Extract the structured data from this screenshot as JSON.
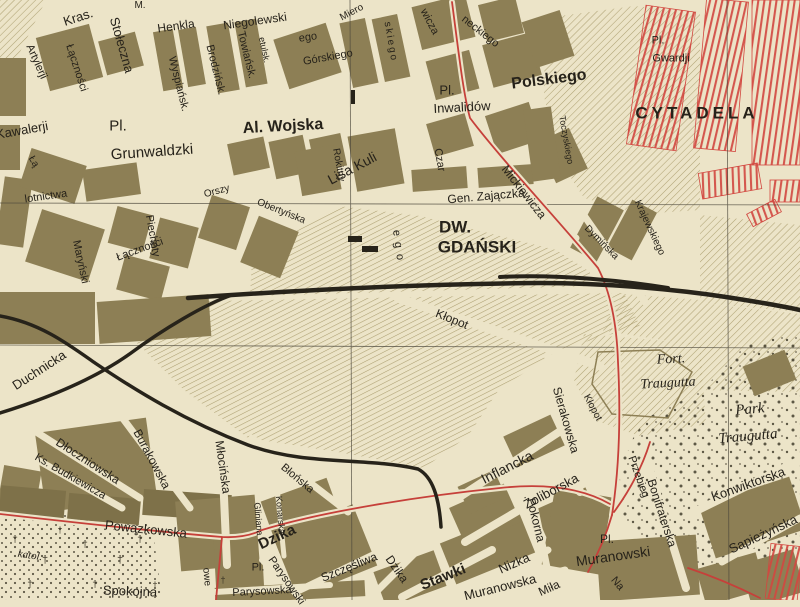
{
  "colors": {
    "paper": "#ece4c8",
    "block": "#8d7f55",
    "blockdk": "#7e7149",
    "hatch": "#9b8c58",
    "rail": "#27231a",
    "road": "#c6403a",
    "redb": "#d24840",
    "ink": "#26221a",
    "grid": "#4a463a"
  },
  "labels": [
    {
      "t": "Kras.",
      "x": 78,
      "y": 17,
      "r": -18,
      "s": 13
    },
    {
      "t": "M.",
      "x": 140,
      "y": 6,
      "r": 0,
      "s": 10
    },
    {
      "t": "Henkla",
      "x": 176,
      "y": 26,
      "r": -8,
      "s": 12
    },
    {
      "t": "Niegolewski",
      "x": 255,
      "y": 21,
      "r": -8,
      "s": 12
    },
    {
      "t": "ego",
      "x": 308,
      "y": 38,
      "r": -8,
      "s": 11
    },
    {
      "t": "Stołeczna",
      "x": 122,
      "y": 45,
      "r": 74,
      "s": 13
    },
    {
      "t": "Artylerji",
      "x": 36,
      "y": 62,
      "r": 66,
      "s": 11
    },
    {
      "t": "Łączności",
      "x": 76,
      "y": 68,
      "r": 72,
      "s": 11
    },
    {
      "t": "Wyspiańsk.",
      "x": 178,
      "y": 84,
      "r": 76,
      "s": 11
    },
    {
      "t": "Brodzińsk.",
      "x": 215,
      "y": 70,
      "r": 76,
      "s": 11
    },
    {
      "t": "Towiańsk.",
      "x": 246,
      "y": 55,
      "r": 76,
      "s": 11
    },
    {
      "t": "etulsk.",
      "x": 264,
      "y": 50,
      "r": 78,
      "s": 9
    },
    {
      "t": "Górskiego",
      "x": 328,
      "y": 58,
      "r": -10,
      "s": 11
    },
    {
      "t": "Kawalerji",
      "x": 22,
      "y": 130,
      "r": -10,
      "s": 13
    },
    {
      "t": "Pl.",
      "x": 118,
      "y": 126,
      "r": 0,
      "s": 15
    },
    {
      "t": "Grunwaldzki",
      "x": 152,
      "y": 152,
      "r": -4,
      "s": 15
    },
    {
      "t": "Łą",
      "x": 33,
      "y": 162,
      "r": 60,
      "s": 10
    },
    {
      "t": "lotnictwa",
      "x": 46,
      "y": 197,
      "r": -8,
      "s": 11
    },
    {
      "t": "Maryński",
      "x": 80,
      "y": 262,
      "r": 78,
      "s": 11
    },
    {
      "t": "Łączności",
      "x": 140,
      "y": 250,
      "r": -20,
      "s": 11
    },
    {
      "t": "Piechoty",
      "x": 152,
      "y": 236,
      "r": 80,
      "s": 11
    },
    {
      "t": "Miero",
      "x": 352,
      "y": 13,
      "r": -28,
      "s": 10
    },
    {
      "t": "skiego",
      "x": 390,
      "y": 42,
      "r": 80,
      "s": 10,
      "ls": 2
    },
    {
      "t": "Al. Wojska",
      "x": 283,
      "y": 127,
      "r": -3,
      "s": 16,
      "b": 1
    },
    {
      "t": "Polskiego",
      "x": 549,
      "y": 80,
      "r": -7,
      "s": 16,
      "b": 1
    },
    {
      "t": "Pl.",
      "x": 447,
      "y": 90,
      "r": 0,
      "s": 13
    },
    {
      "t": "Inwalidów",
      "x": 462,
      "y": 107,
      "r": -3,
      "s": 13
    },
    {
      "t": "wicza",
      "x": 429,
      "y": 22,
      "r": 62,
      "s": 11
    },
    {
      "t": "neckiego",
      "x": 480,
      "y": 32,
      "r": 38,
      "s": 11
    },
    {
      "t": "Czar",
      "x": 439,
      "y": 160,
      "r": 80,
      "s": 11
    },
    {
      "t": "Mickiewicza",
      "x": 524,
      "y": 192,
      "r": 52,
      "s": 12
    },
    {
      "t": "Toczyskiego",
      "x": 566,
      "y": 140,
      "r": 80,
      "s": 9
    },
    {
      "t": "Pl.",
      "x": 658,
      "y": 41,
      "r": 0,
      "s": 11
    },
    {
      "t": "Gwardji",
      "x": 671,
      "y": 59,
      "r": 0,
      "s": 11
    },
    {
      "t": "CYTADELA",
      "x": 697,
      "y": 113,
      "r": 0,
      "s": 17,
      "b": 1,
      "ls": 4
    },
    {
      "t": "Orszy",
      "x": 217,
      "y": 192,
      "r": -15,
      "s": 10
    },
    {
      "t": "Obertyńska",
      "x": 281,
      "y": 212,
      "r": 22,
      "s": 10
    },
    {
      "t": "Rokitny",
      "x": 338,
      "y": 165,
      "r": 80,
      "s": 10
    },
    {
      "t": "Lisa Kuli",
      "x": 352,
      "y": 168,
      "r": -28,
      "s": 14
    },
    {
      "t": "Gen. Zajączka",
      "x": 486,
      "y": 196,
      "r": -5,
      "s": 12
    },
    {
      "t": "ego",
      "x": 398,
      "y": 248,
      "r": 82,
      "s": 11,
      "ls": 6
    },
    {
      "t": "DW.",
      "x": 455,
      "y": 227,
      "r": 0,
      "s": 17,
      "b": 1
    },
    {
      "t": "GDAŃSKI",
      "x": 477,
      "y": 247,
      "r": 0,
      "s": 17,
      "b": 1
    },
    {
      "t": "Kłopot",
      "x": 452,
      "y": 319,
      "r": 22,
      "s": 12
    },
    {
      "t": "Krajewskiego",
      "x": 649,
      "y": 228,
      "r": 65,
      "s": 10
    },
    {
      "t": "Dymińska",
      "x": 601,
      "y": 243,
      "r": 45,
      "s": 10
    },
    {
      "t": "Fort.",
      "x": 671,
      "y": 360,
      "r": -3,
      "s": 14,
      "f": 1
    },
    {
      "t": "Traugutta",
      "x": 668,
      "y": 384,
      "r": -3,
      "s": 14,
      "f": 1
    },
    {
      "t": "Park",
      "x": 750,
      "y": 410,
      "r": -5,
      "s": 15,
      "f": 1
    },
    {
      "t": "Traugutta",
      "x": 748,
      "y": 437,
      "r": -5,
      "s": 15,
      "f": 1
    },
    {
      "t": "Konwiktorska",
      "x": 748,
      "y": 484,
      "r": -20,
      "s": 13
    },
    {
      "t": "Sapieżyńska",
      "x": 763,
      "y": 534,
      "r": -25,
      "s": 13
    },
    {
      "t": "Bonifraterska",
      "x": 662,
      "y": 513,
      "r": 72,
      "s": 12
    },
    {
      "t": "Przebieg",
      "x": 638,
      "y": 477,
      "r": 70,
      "s": 11
    },
    {
      "t": "Kłopot",
      "x": 592,
      "y": 408,
      "r": 62,
      "s": 10
    },
    {
      "t": "Sierakowska",
      "x": 566,
      "y": 420,
      "r": 74,
      "s": 12
    },
    {
      "t": "Inflancka",
      "x": 507,
      "y": 467,
      "r": -27,
      "s": 14
    },
    {
      "t": "Pokorna",
      "x": 536,
      "y": 520,
      "r": 76,
      "s": 12
    },
    {
      "t": "Żoliborska",
      "x": 551,
      "y": 491,
      "r": -28,
      "s": 13
    },
    {
      "t": "Stawki",
      "x": 443,
      "y": 577,
      "r": -22,
      "s": 15,
      "b": 1
    },
    {
      "t": "Nizka",
      "x": 514,
      "y": 563,
      "r": -24,
      "s": 13
    },
    {
      "t": "Muranowska",
      "x": 500,
      "y": 587,
      "r": -14,
      "s": 13
    },
    {
      "t": "Pl.",
      "x": 607,
      "y": 539,
      "r": 0,
      "s": 12
    },
    {
      "t": "Muranowski",
      "x": 613,
      "y": 556,
      "r": -8,
      "s": 14
    },
    {
      "t": "Miła",
      "x": 549,
      "y": 588,
      "r": -24,
      "s": 12
    },
    {
      "t": "Na",
      "x": 617,
      "y": 584,
      "r": 50,
      "s": 11
    },
    {
      "t": "Duchnicka",
      "x": 39,
      "y": 370,
      "r": -33,
      "s": 13
    },
    {
      "t": "Dłoczniowska",
      "x": 88,
      "y": 461,
      "r": 33,
      "s": 12
    },
    {
      "t": "Ks. Budkiewicza",
      "x": 70,
      "y": 477,
      "r": 30,
      "s": 11
    },
    {
      "t": "Burakowska",
      "x": 152,
      "y": 459,
      "r": 62,
      "s": 12
    },
    {
      "t": "Młocińska",
      "x": 223,
      "y": 467,
      "r": 82,
      "s": 12
    },
    {
      "t": "Powązkowska",
      "x": 146,
      "y": 529,
      "r": 6,
      "s": 13
    },
    {
      "t": "katol.",
      "x": 30,
      "y": 556,
      "r": 8,
      "s": 11,
      "f": 1
    },
    {
      "t": "Spokojna",
      "x": 130,
      "y": 591,
      "r": 2,
      "s": 13
    },
    {
      "t": "owe",
      "x": 206,
      "y": 577,
      "r": 85,
      "s": 10
    },
    {
      "t": "Błońska",
      "x": 297,
      "y": 479,
      "r": 40,
      "s": 11
    },
    {
      "t": "Gliniana",
      "x": 258,
      "y": 519,
      "r": 85,
      "s": 9
    },
    {
      "t": "Konarska",
      "x": 280,
      "y": 515,
      "r": 85,
      "s": 9
    },
    {
      "t": "Dzika",
      "x": 277,
      "y": 537,
      "r": -25,
      "s": 15,
      "b": 1
    },
    {
      "t": "Pl.",
      "x": 258,
      "y": 568,
      "r": 0,
      "s": 11
    },
    {
      "t": "Parysowski",
      "x": 286,
      "y": 581,
      "r": 55,
      "s": 11
    },
    {
      "t": "Parysowska",
      "x": 262,
      "y": 592,
      "r": -3,
      "s": 11
    },
    {
      "t": "Szczęśliwa",
      "x": 349,
      "y": 567,
      "r": -22,
      "s": 12
    },
    {
      "t": "Dzika",
      "x": 397,
      "y": 569,
      "r": 55,
      "s": 12
    }
  ],
  "symbols": [
    {
      "g": "†",
      "x": 15,
      "y": 540,
      "s": 10
    },
    {
      "g": "†",
      "x": 45,
      "y": 560,
      "s": 11
    },
    {
      "g": "†",
      "x": 85,
      "y": 545,
      "s": 10
    },
    {
      "g": "†",
      "x": 120,
      "y": 560,
      "s": 11
    },
    {
      "g": "†",
      "x": 30,
      "y": 585,
      "s": 10
    },
    {
      "g": "†",
      "x": 95,
      "y": 585,
      "s": 10
    },
    {
      "g": "†",
      "x": 140,
      "y": 540,
      "s": 10
    },
    {
      "g": "†",
      "x": 60,
      "y": 530,
      "s": 9
    },
    {
      "g": "†",
      "x": 155,
      "y": 585,
      "s": 9
    },
    {
      "g": "†",
      "x": 223,
      "y": 580,
      "s": 9
    }
  ]
}
